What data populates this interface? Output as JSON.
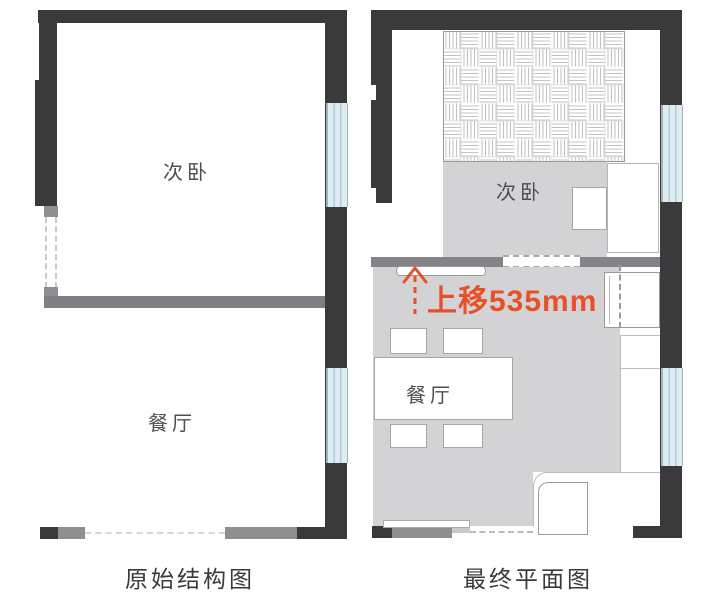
{
  "page": {
    "title": "floor plan comparison"
  },
  "colors": {
    "wall_dark": "#3a3a3c",
    "wall_gray": "#7f7f83",
    "floor_gray": "#d3d3d5",
    "window_blue": "#dcedf1",
    "window_line": "#9eb4ba",
    "annotation_red": "#e8502a",
    "text_dark": "#3a3a3c"
  },
  "left_plan": {
    "caption": "原始结构图",
    "bedroom_label": "次卧",
    "dining_label": "餐厅"
  },
  "right_plan": {
    "caption": "最终平面图",
    "bedroom_label": "次卧",
    "dining_label": "餐厅",
    "annotation": "上移535mm"
  }
}
